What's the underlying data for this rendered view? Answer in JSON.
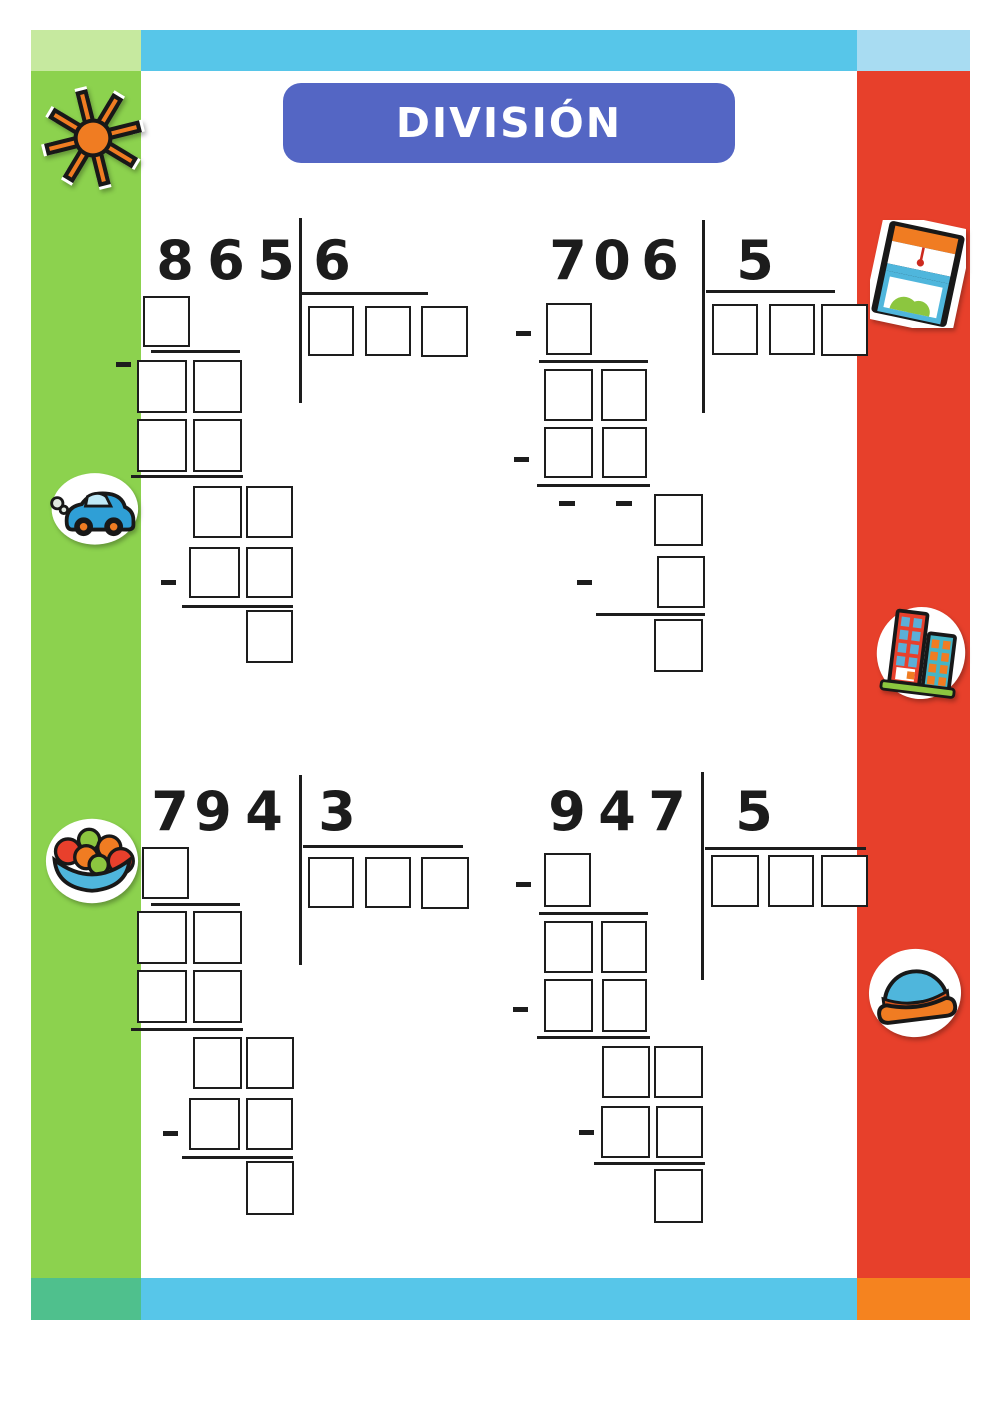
{
  "title": "DIVISIÓN",
  "problems": [
    {
      "dividend": "865",
      "dividend_digits": [
        "8",
        "6",
        "5"
      ],
      "divisor": "6",
      "quotient_boxes": 3
    },
    {
      "dividend": "706",
      "dividend_digits": [
        "7",
        "0",
        "6"
      ],
      "divisor": "5",
      "quotient_boxes": 3
    },
    {
      "dividend": "794",
      "dividend_digits": [
        "7",
        "9",
        "4"
      ],
      "divisor": "3",
      "quotient_boxes": 3
    },
    {
      "dividend": "947",
      "dividend_digits": [
        "9",
        "4",
        "7"
      ],
      "divisor": "5",
      "quotient_boxes": 3
    }
  ],
  "stickers": {
    "left": [
      "sun-sticker",
      "car-sticker",
      "fruit-bowl-sticker"
    ],
    "right": [
      "window-sticker",
      "buildings-sticker",
      "sofa-sticker"
    ]
  },
  "colors": {
    "left_band": "#8cd24e",
    "left_band_top_cap": "#c6e99f",
    "top_bar": "#57c6e9",
    "top_bar_right_cap": "#a8dcf2",
    "right_band": "#e7402b",
    "bottom_left_cap": "#4fc08d",
    "bottom_bar": "#57c6e9",
    "bottom_right_cap": "#f5831f",
    "title_background": "#5466c4",
    "title_text": "#ffffff",
    "ink": "#1d1d1d",
    "sticker_orange": "#f07c22",
    "sticker_blue": "#4fb6dc",
    "sticker_green": "#8cc63f",
    "sticker_red": "#e8402c"
  }
}
